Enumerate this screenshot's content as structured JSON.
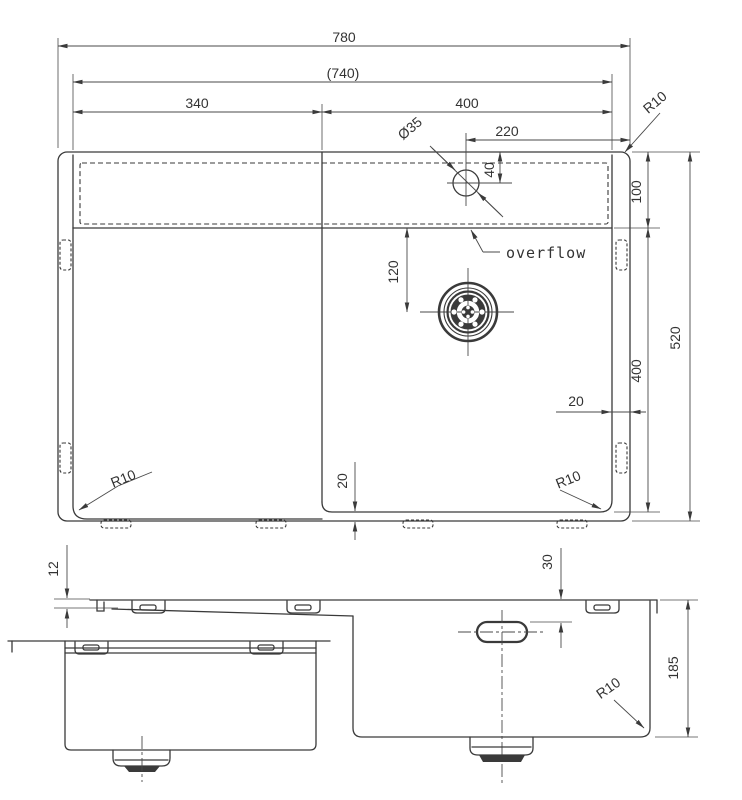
{
  "drawing": {
    "type": "sink-technical-drawing",
    "line_color": "#3a3a3a",
    "background": "#ffffff"
  },
  "top_view": {
    "dim_overall_width": "780",
    "dim_inner_width": "(740)",
    "dim_left_bowl_width": "340",
    "dim_right_bowl_width": "400",
    "dim_faucet_from_right": "220",
    "dim_faucet_diameter": "Ø35",
    "dim_faucet_from_top": "40",
    "dim_ledge_depth": "100",
    "dim_bowl_length": "400",
    "dim_overall_depth": "520",
    "dim_drain_from_top": "120",
    "dim_rim_gap_right": "20",
    "dim_rim_gap_bottom": "20",
    "radius_top_right": "R10",
    "radius_bottom_left": "R10",
    "radius_bottom_right": "R10",
    "overflow_label": "overflow"
  },
  "front_view": {
    "dim_rim_thickness": "12",
    "dim_overflow_from_top": "30",
    "dim_bowl_depth": "185",
    "radius_bottom_right": "R10"
  }
}
